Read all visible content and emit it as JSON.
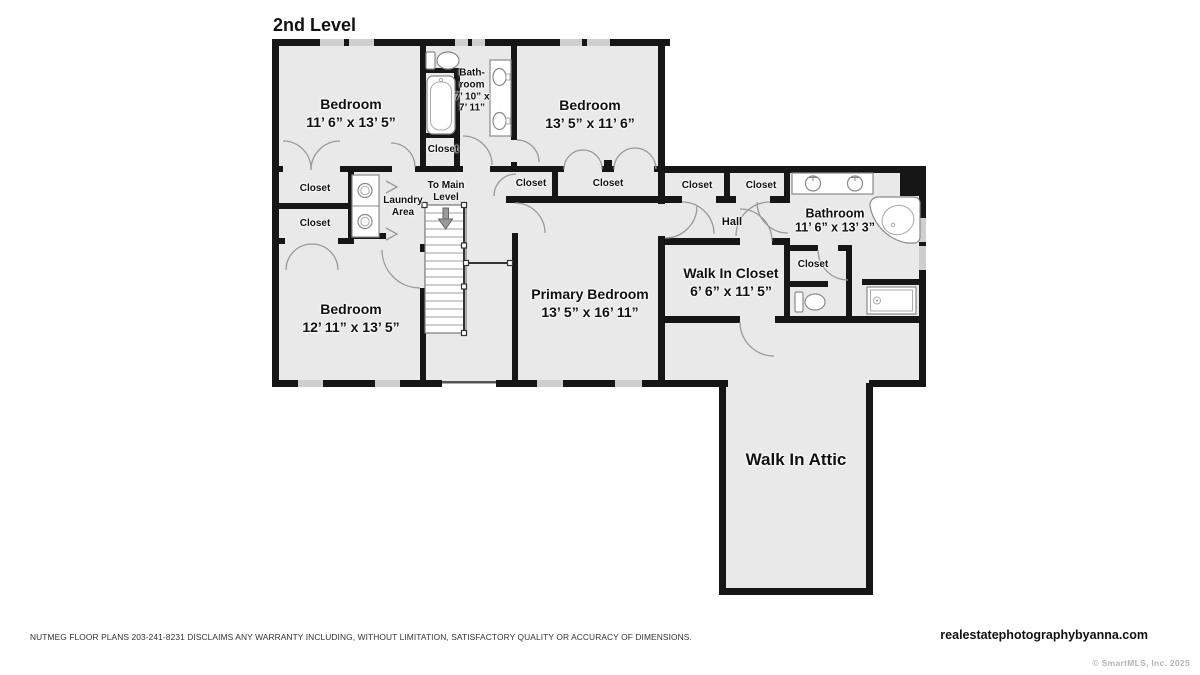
{
  "title": "2nd Level",
  "closet_label": "Closet",
  "rooms": {
    "bedroom1": {
      "name": "Bedroom",
      "dims": "11’ 6” x 13’ 5”"
    },
    "bathroom1": {
      "line1": "Bath-",
      "line2": "room",
      "line3": "7’ 10” x",
      "line4": "7’ 11”"
    },
    "bedroom2": {
      "name": "Bedroom",
      "dims": "13’ 5” x 11’ 6”"
    },
    "bedroom3": {
      "name": "Bedroom",
      "dims": "12’ 11” x 13’ 5”"
    },
    "primary_bedroom": {
      "name": "Primary Bedroom",
      "dims": "13’ 5” x 16’ 11”"
    },
    "walk_in_closet": {
      "name": "Walk In Closet",
      "dims": "6’ 6” x 11’ 5”"
    },
    "bathroom2": {
      "name": "Bathroom",
      "dims": "11’ 6” x 13’ 3”"
    },
    "walk_in_attic": {
      "name": "Walk In Attic"
    },
    "hall": {
      "name": "Hall"
    },
    "laundry": {
      "line1": "Laundry",
      "line2": "Area"
    },
    "stairs": {
      "line1": "To Main",
      "line2": "Level"
    }
  },
  "footer": {
    "disclaimer": "NUTMEG FLOOR PLANS 203-241-8231 DISCLAIMS ANY WARRANTY INCLUDING, WITHOUT LIMITATION, SATISFACTORY QUALITY OR ACCURACY OF DIMENSIONS.",
    "website": "realestatephotographybyanna.com",
    "credit": "© SmartMLS, Inc.  2025"
  },
  "colors": {
    "wall": "#161616",
    "floor": "#e9e9e9",
    "window": "#cfcfcf",
    "door_arc": "#9a9a9a",
    "credit_text": "#b5b5b5"
  }
}
